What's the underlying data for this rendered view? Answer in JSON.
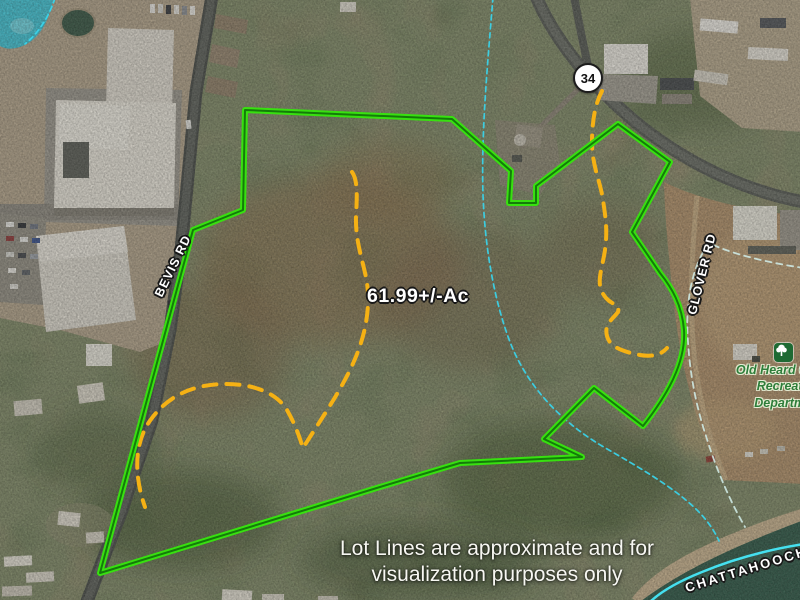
{
  "map": {
    "route_badge": "34",
    "road_labels": {
      "bevis": "BEVIS RD",
      "glover": "GLOVER RD"
    },
    "river_label": "CHATTAHOOCHEE",
    "acreage_label": "61.99+/-Ac",
    "poi": {
      "icon": "tree-icon",
      "line1": "Old Heard County",
      "line2": "Recreation",
      "line3": "Department"
    },
    "disclaimer": {
      "line1": "Lot Lines are approximate and for",
      "line2": "visualization purposes only"
    },
    "colors": {
      "boundary_green": "#38e010",
      "boundary_core_green": "#11700a",
      "lot_line_yellow": "#f5b114",
      "stream_cyan": "#3ad2e8",
      "trail_pale": "#cde8e2",
      "river_line_cyan": "#45e0ef",
      "lake_cyan": "#38c5d8",
      "poi_green": "#2e7d3a"
    }
  }
}
